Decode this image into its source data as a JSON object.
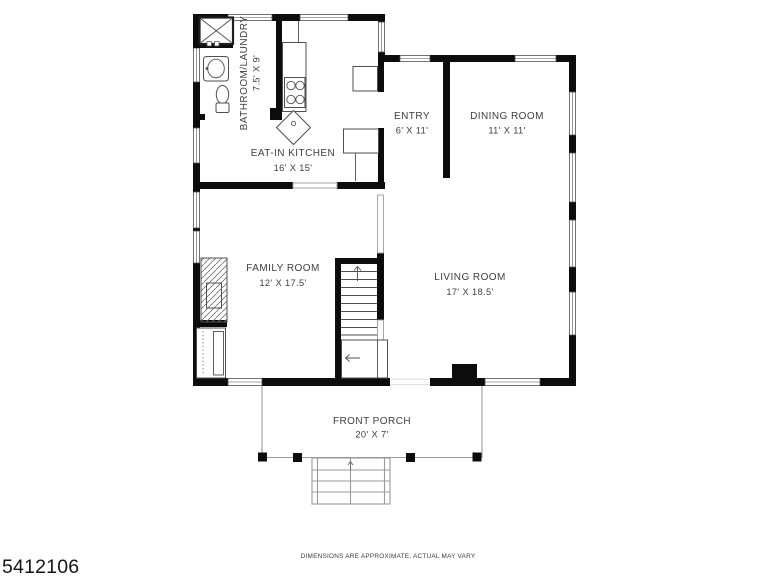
{
  "image": {
    "photo_id": "5412106",
    "disclaimer": "DIMENSIONS ARE APPROXIMATE, ACTUAL MAY VARY"
  },
  "rooms": [
    {
      "id": "bathroom-laundry",
      "name": "BATHROOM/LAUNDRY",
      "dims": "7.5' X 9'"
    },
    {
      "id": "eat-in-kitchen",
      "name": "EAT-IN KITCHEN",
      "dims": "16' X 15'"
    },
    {
      "id": "entry",
      "name": "ENTRY",
      "dims": "6' X 11'"
    },
    {
      "id": "dining-room",
      "name": "DINING ROOM",
      "dims": "11' X 11'"
    },
    {
      "id": "family-room",
      "name": "FAMILY ROOM",
      "dims": "12' X 17.5'"
    },
    {
      "id": "living-room",
      "name": "LIVING ROOM",
      "dims": "17' X 18.5'"
    },
    {
      "id": "front-porch",
      "name": "FRONT PORCH",
      "dims": "20' X 7'"
    }
  ],
  "colors": {
    "wall": "#0c0c0c",
    "background": "#ffffff",
    "fixture_line": "#4f4f4f",
    "light_line": "#9a9a9a",
    "label_text": "#3e3e3e"
  }
}
